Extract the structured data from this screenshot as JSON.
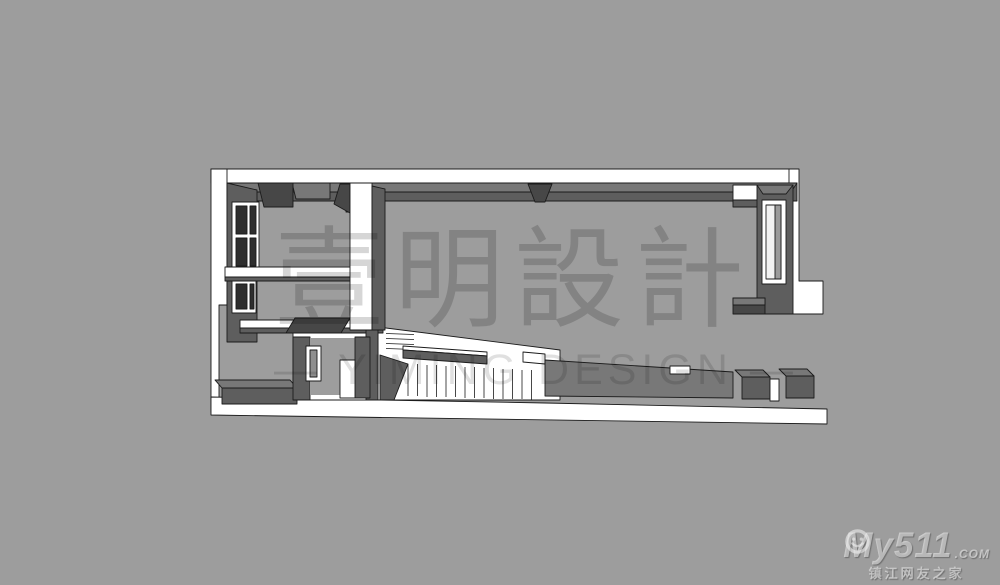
{
  "watermark": {
    "chinese": "壹明設計",
    "english": "— YIMING DESIGN —"
  },
  "logo": {
    "brand_prefix": "My",
    "brand_suffix": "511",
    "brand_tld": ".COM",
    "tagline": "镇江网友之家",
    "smiley_icon": "smiley-face-icon"
  },
  "colors": {
    "bg": "#9d9d9d",
    "slab": "#ffffff",
    "wall-top": "#787878",
    "wall-face": "#5e5e5e",
    "wall-dark": "#474747",
    "pane": "#2e2e2e",
    "outline": "#1b1b1b",
    "wm": "rgba(0,0,0,0.16)",
    "wm2": "rgba(0,0,0,0.12)",
    "logo": "rgba(244,244,244,0.55)",
    "logo-shadow": "rgba(55,55,55,0.45)"
  }
}
